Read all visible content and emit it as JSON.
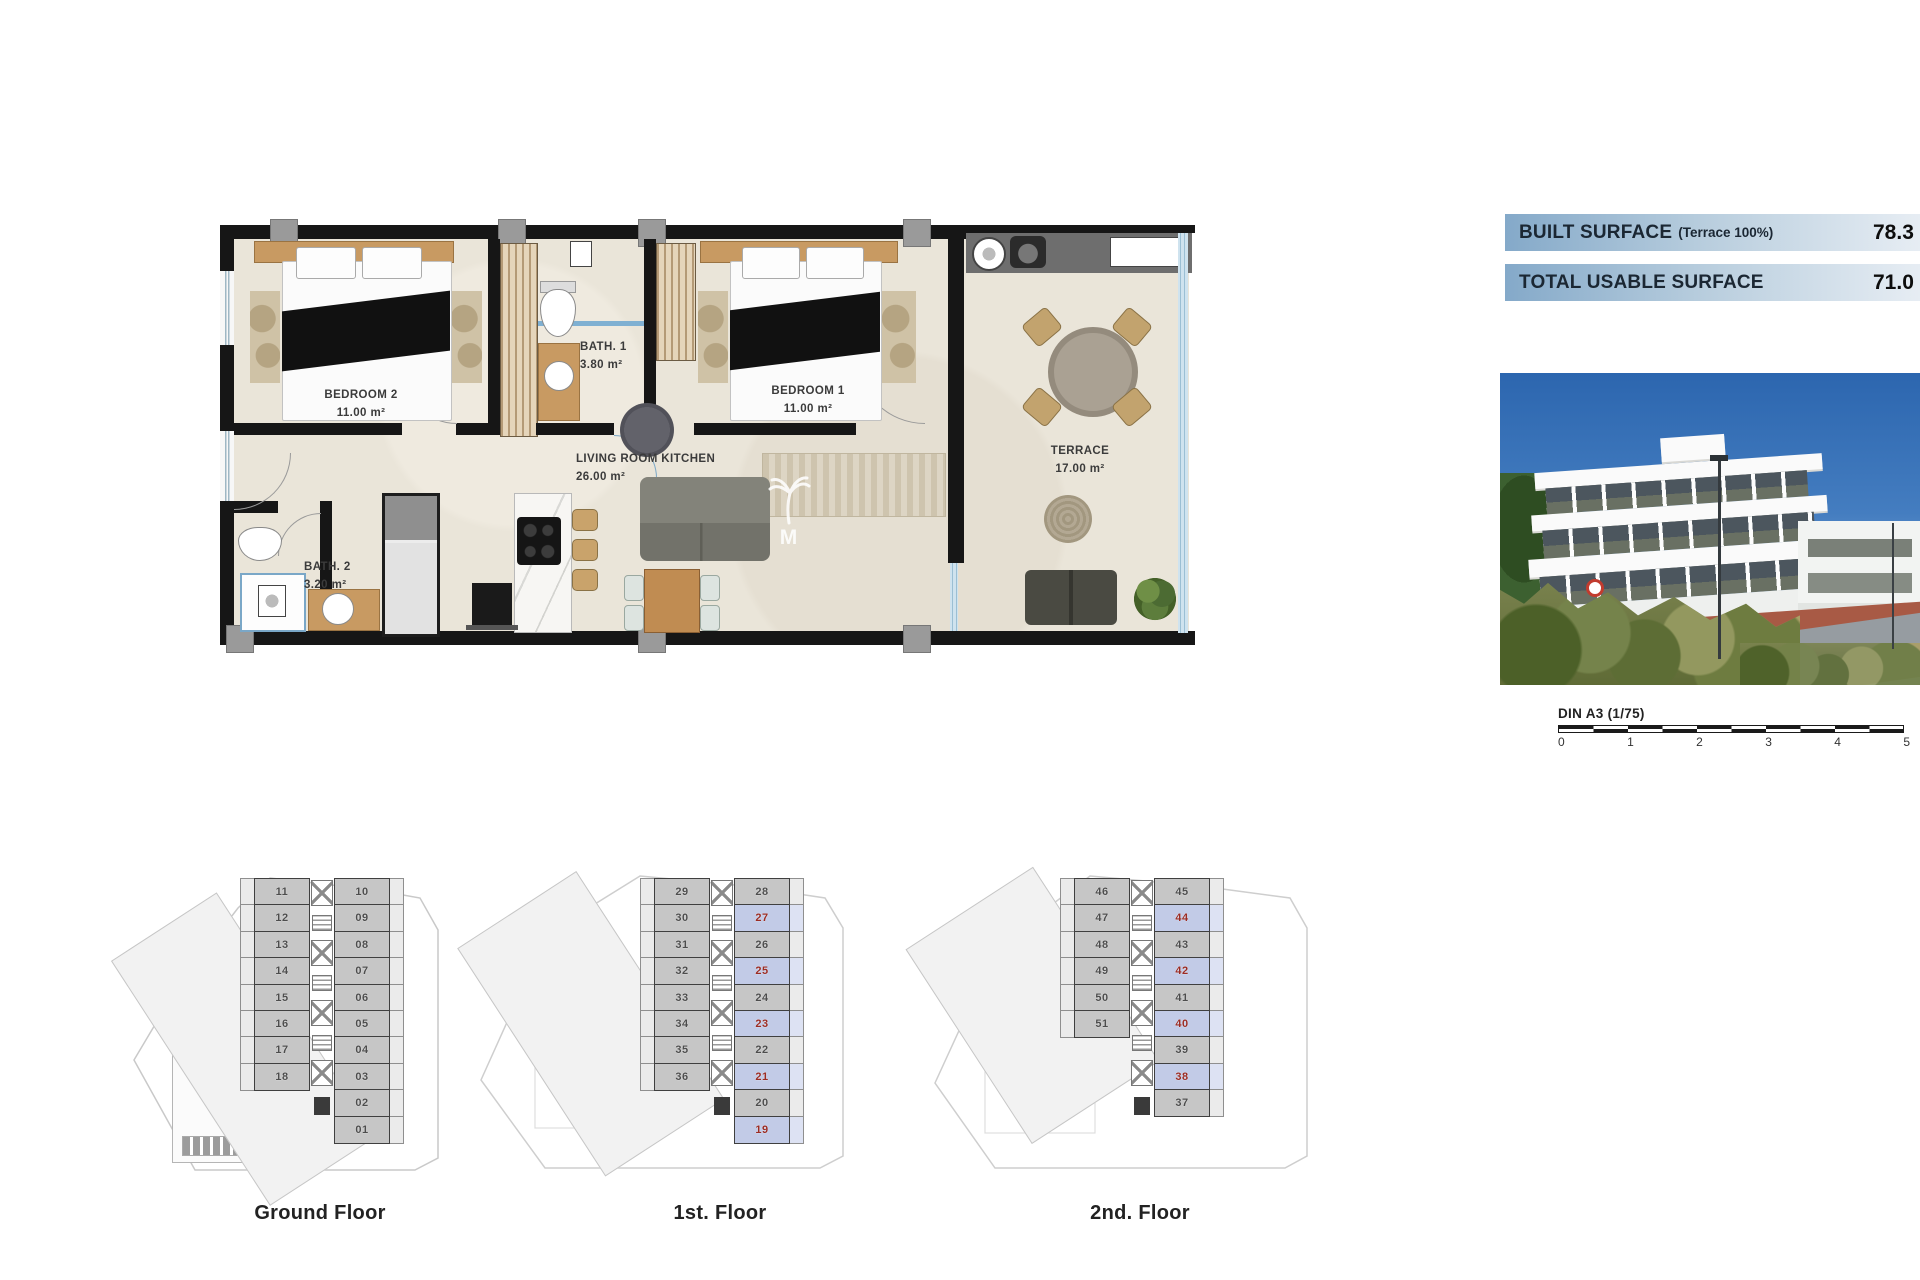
{
  "main_plan": {
    "rooms": {
      "bedroom2": {
        "name": "BEDROOM 2",
        "area": "11.00 m²"
      },
      "bath1": {
        "name": "BATH. 1",
        "area": "3.80 m²"
      },
      "bedroom1": {
        "name": "BEDROOM 1",
        "area": "11.00 m²"
      },
      "living": {
        "name": "LIVING ROOM KITCHEN",
        "area": "26.00 m²"
      },
      "bath2": {
        "name": "BATH. 2",
        "area": "3.20 m²"
      },
      "terrace": {
        "name": "TERRACE",
        "area": "17.00 m²"
      }
    },
    "watermark_letter": "M"
  },
  "surface_panel": {
    "rows": [
      {
        "label": "BUILT SURFACE",
        "sublabel": "(Terrace 100%)",
        "value": "78.3"
      },
      {
        "label": "TOTAL USABLE SURFACE",
        "sublabel": "",
        "value": "71.0"
      }
    ]
  },
  "scale_bar": {
    "label": "DIN A3 (1/75)",
    "ticks": [
      "0",
      "1",
      "2",
      "3",
      "4",
      "5"
    ]
  },
  "floors": [
    {
      "label": "Ground Floor",
      "left_units": [
        "11",
        "12",
        "13",
        "14",
        "15",
        "16",
        "17",
        "18"
      ],
      "right_units": [
        "10",
        "09",
        "08",
        "07",
        "06",
        "05",
        "04",
        "03",
        "02",
        "01"
      ],
      "highlighted_units": [],
      "diagonal_units": [
        "58",
        "57",
        "56",
        "55"
      ]
    },
    {
      "label": "1st. Floor",
      "left_units": [
        "29",
        "30",
        "31",
        "32",
        "33",
        "34",
        "35",
        "36"
      ],
      "right_units": [
        "28",
        "27",
        "26",
        "25",
        "24",
        "23",
        "22",
        "21",
        "20",
        "19"
      ],
      "highlighted_units": [
        "27",
        "25",
        "23",
        "21",
        "19"
      ],
      "diagonal_units": [
        "61",
        "60",
        "59"
      ]
    },
    {
      "label": "2nd. Floor",
      "left_units": [
        "46",
        "47",
        "48",
        "49",
        "50",
        "51"
      ],
      "right_units": [
        "45",
        "44",
        "43",
        "42",
        "41",
        "40",
        "39",
        "38",
        "37"
      ],
      "highlighted_units": [
        "44",
        "42",
        "40",
        "38"
      ],
      "diagonal_units": [
        "63",
        "62"
      ]
    }
  ],
  "colors": {
    "panel_blue": "#84a9c9",
    "highlight_blue": "#c2cbe7",
    "highlight_number_red": "#9b2c24",
    "wall_black": "#161616",
    "floor_beige": "#eae5d9"
  }
}
